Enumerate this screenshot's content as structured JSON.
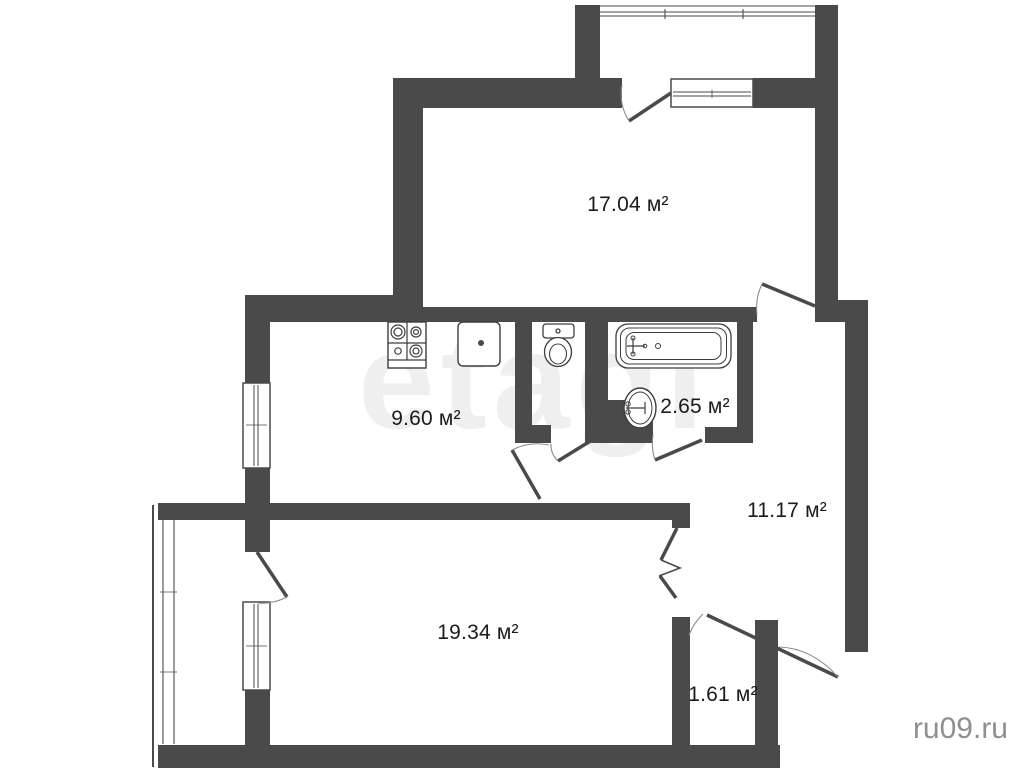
{
  "floorplan": {
    "unit_suffix": "м²",
    "rooms": [
      {
        "name": "living-room-top",
        "area": "17.04 м²"
      },
      {
        "name": "kitchen",
        "area": "9.60 м²"
      },
      {
        "name": "bathroom",
        "area": "2.65 м²"
      },
      {
        "name": "hallway",
        "area": "11.17 м²"
      },
      {
        "name": "living-room-main",
        "area": "19.34 м²"
      },
      {
        "name": "storage",
        "area": "1.61 м²"
      }
    ],
    "fixtures": [
      "stove-icon",
      "kitchen-sink-icon",
      "toilet-icon",
      "bathtub-icon",
      "washbasin-icon"
    ],
    "watermarks": {
      "center": "etagi",
      "corner": "ru09.ru"
    },
    "colors": {
      "wall": "#4a4a4a",
      "paper": "#ffffff",
      "label_text": "#1b1b1b",
      "door_arc": "#8a8a8a",
      "center_watermark": "rgba(100,100,100,0.10)",
      "corner_watermark": "#8f8f8f"
    }
  }
}
